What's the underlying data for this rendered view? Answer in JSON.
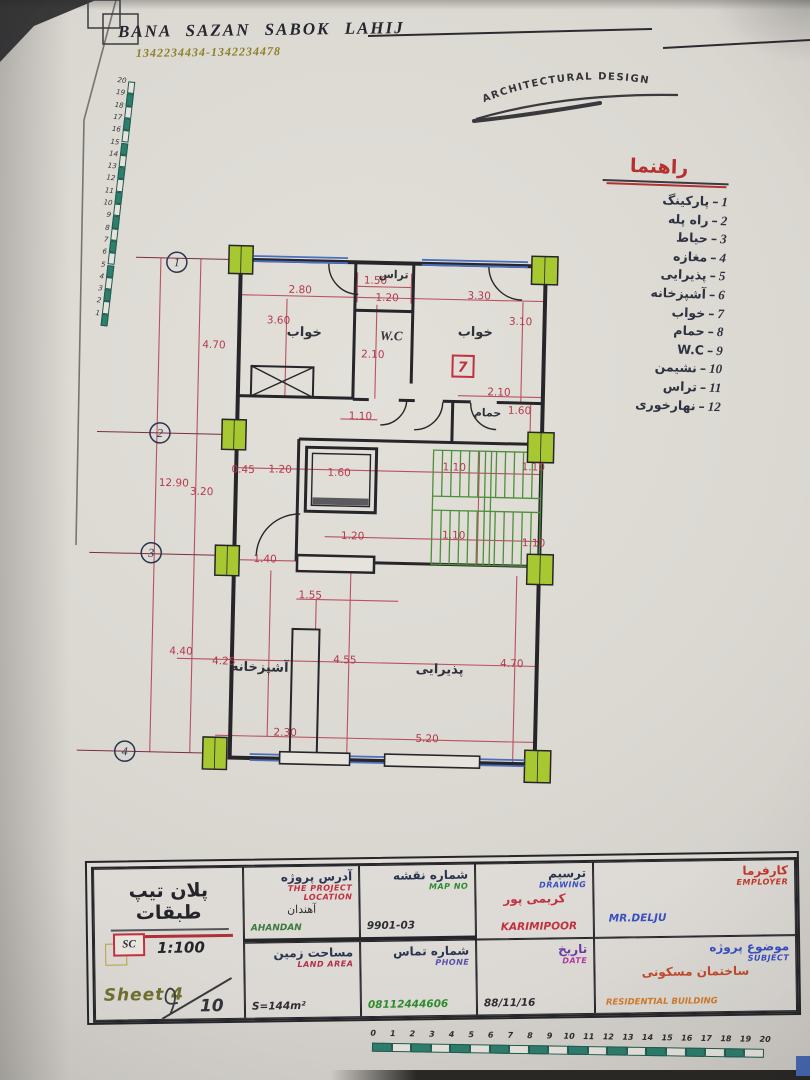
{
  "photo": {
    "header": {
      "company": "BANA SAZAN  SABOK LAHIJ",
      "phones": "1342234434-1342234478",
      "logo": "ARCHITECTURAL   DESIGN"
    },
    "legend": {
      "title": "راهنما",
      "items": [
        {
          "num": "1",
          "label": "پارکینگ"
        },
        {
          "num": "2",
          "label": "راه پله"
        },
        {
          "num": "3",
          "label": "حیاط"
        },
        {
          "num": "4",
          "label": "مغازه"
        },
        {
          "num": "5",
          "label": "پذیرایی"
        },
        {
          "num": "6",
          "label": "آشپزخانه"
        },
        {
          "num": "7",
          "label": "خواب"
        },
        {
          "num": "8",
          "label": "حمام"
        },
        {
          "num": "9",
          "label": "W.C"
        },
        {
          "num": "10",
          "label": "نشیمن"
        },
        {
          "num": "11",
          "label": "تراس"
        },
        {
          "num": "12",
          "label": "نهارخوری"
        }
      ]
    },
    "plan": {
      "room_tag": "7",
      "grid_bubbles": [
        {
          "n": "1",
          "x": 101,
          "y": 34
        },
        {
          "n": "2",
          "x": 88,
          "y": 205
        },
        {
          "n": "3",
          "x": 82,
          "y": 325
        },
        {
          "n": "4",
          "x": 60,
          "y": 524
        }
      ],
      "rooms": [
        {
          "t": "خواب",
          "x": 230,
          "y": 105,
          "cls": "room"
        },
        {
          "t": "تراس",
          "x": 318,
          "y": 45,
          "cls": "room room-small"
        },
        {
          "t": "W.C",
          "x": 317,
          "y": 107,
          "cls": "room wc"
        },
        {
          "t": "خواب",
          "x": 401,
          "y": 101,
          "cls": "room"
        },
        {
          "t": "حمام",
          "x": 415,
          "y": 181,
          "cls": "room room-small"
        },
        {
          "t": "آشپزخانه",
          "x": 193,
          "y": 441,
          "cls": "room"
        },
        {
          "t": "پذیرایی",
          "x": 373,
          "y": 439,
          "cls": "room"
        }
      ],
      "dims": [
        {
          "v": "2.80",
          "x": 225,
          "y": 62
        },
        {
          "v": "1.50",
          "x": 300,
          "y": 51
        },
        {
          "v": "1.20",
          "x": 312,
          "y": 68
        },
        {
          "v": "3.30",
          "x": 404,
          "y": 64
        },
        {
          "v": "3.60",
          "x": 204,
          "y": 93
        },
        {
          "v": "3.10",
          "x": 446,
          "y": 89
        },
        {
          "v": "4.70",
          "x": 140,
          "y": 119
        },
        {
          "v": "2.10",
          "x": 299,
          "y": 125
        },
        {
          "v": "2.10",
          "x": 426,
          "y": 160
        },
        {
          "v": "1.60",
          "x": 447,
          "y": 178
        },
        {
          "v": "1.10",
          "x": 288,
          "y": 187
        },
        {
          "v": "12.90",
          "x": 103,
          "y": 258
        },
        {
          "v": "3.20",
          "x": 131,
          "y": 266
        },
        {
          "v": "0.45",
          "x": 172,
          "y": 243
        },
        {
          "v": "1.20",
          "x": 209,
          "y": 242
        },
        {
          "v": "1.60",
          "x": 268,
          "y": 244
        },
        {
          "v": "1.10",
          "x": 383,
          "y": 236
        },
        {
          "v": "1.10",
          "x": 462,
          "y": 234
        },
        {
          "v": "1.20",
          "x": 283,
          "y": 307
        },
        {
          "v": "1.10",
          "x": 384,
          "y": 304
        },
        {
          "v": "1.10",
          "x": 464,
          "y": 310
        },
        {
          "v": "1.40",
          "x": 196,
          "y": 332
        },
        {
          "v": "1.55",
          "x": 242,
          "y": 367
        },
        {
          "v": "4.40",
          "x": 114,
          "y": 426
        },
        {
          "v": "4.25",
          "x": 157,
          "y": 435
        },
        {
          "v": "4.55",
          "x": 278,
          "y": 431
        },
        {
          "v": "4.70",
          "x": 445,
          "y": 431
        },
        {
          "v": "2.30",
          "x": 220,
          "y": 505
        },
        {
          "v": "5.20",
          "x": 362,
          "y": 508
        }
      ]
    },
    "rulers": {
      "left_numbers": [
        "1",
        "2",
        "3",
        "4",
        "5",
        "6",
        "7",
        "8",
        "9",
        "10",
        "11",
        "12",
        "13",
        "14",
        "15",
        "16",
        "17",
        "18",
        "19",
        "20"
      ],
      "bottom_numbers": [
        "0",
        "1",
        "2",
        "3",
        "4",
        "5",
        "6",
        "7",
        "8",
        "9",
        "10",
        "11",
        "12",
        "13",
        "14",
        "15",
        "16",
        "17",
        "18",
        "19",
        "20"
      ]
    },
    "titleblock": {
      "panel": {
        "title": "پلان تیپ طبقات",
        "sc": "SC",
        "scale": "1:100",
        "sheet": "Sheet 4",
        "total": "10"
      },
      "address": {
        "fa": "آدرس پروژه",
        "en": "THE PROJECT LOCATION",
        "value_fa": "آهندان",
        "value_en": "AHANDAN"
      },
      "map_no": {
        "fa": "شماره نقشه",
        "en": "MAP NO",
        "value": "9901-03"
      },
      "drawing": {
        "fa": "ترسیم",
        "en": "DRAWING",
        "value_fa": "کریمی پور",
        "value_en": "KARIMIPOOR"
      },
      "employer": {
        "fa": "کارفرما",
        "en": "EMPLOYER",
        "value": "MR.DELJU"
      },
      "land_area": {
        "fa": "مساحت زمین",
        "en": "LAND AREA",
        "value": "S=144m²"
      },
      "phone": {
        "fa": "شماره تماس",
        "en": "PHONE",
        "value": "08112444606"
      },
      "date": {
        "fa": "تاریخ",
        "en": "DATE",
        "value": "88/11/16"
      },
      "subject": {
        "fa": "موضوع پروژه",
        "en": "SUBJECT",
        "value_fa": "ساختمان مسکونی",
        "value_en": "RESIDENTIAL BUILDING"
      }
    }
  }
}
